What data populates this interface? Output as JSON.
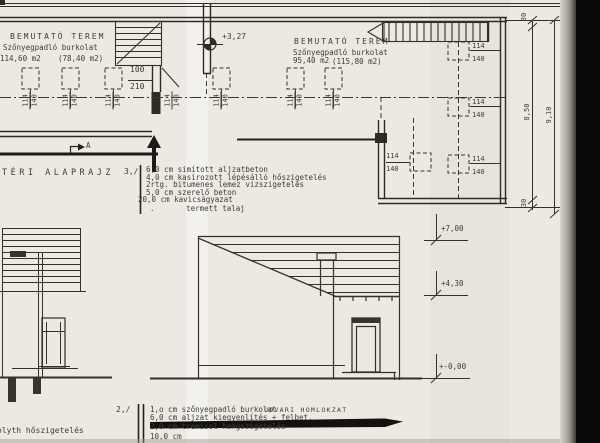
{
  "drawing": {
    "plan": {
      "title": "TÉRI ALAPRAJZ",
      "rooms": [
        {
          "name": "BEMUTATÓ TEREM",
          "finish": "Szőnyegpadló burkolat",
          "area": "114,60 m2",
          "area_alt": "(78,40 m2)"
        },
        {
          "name": "BEMUTATÓ TEREM",
          "finish": "Szőnyegpadló burkolat",
          "area": "95,40 m2",
          "area_alt": "(115,80 m2)"
        }
      ],
      "level_mark": "+3,27",
      "door_width": "100",
      "door_height": "210",
      "opening_width": "114",
      "opening_height": "140",
      "section_letter": "A"
    },
    "dims": {
      "top_wall": "30",
      "bottom_wall": "30",
      "inner": "8,50",
      "outer": "9,10"
    },
    "floor_notes": {
      "index": "3,/",
      "lines": [
        "6,0 cm simított aljzatbeton",
        "4,0 cm kasírozott lépésálló hőszigetelés",
        "2rtg. bitumenes lemez vizszigetelés",
        "5,0 cm szerelő beton",
        "20,0 cm kavicságyazat",
        ".       termett talaj"
      ]
    },
    "slab_notes": {
      "index": "2,/",
      "lines": [
        "1,o cm szőnyegpadló burkolat",
        "6,0 cm aljzat kiegyenlítés + felbet.",
        "2,0 cm tremisol hangszigetelés",
        "10,0 cm"
      ]
    },
    "elevation": {
      "title": "UDVARI HOMLOKZAT",
      "level_ridge": "+7,00",
      "level_eaves": "+4,30",
      "level_ground": "+-0,00"
    },
    "edge_text": "olyth hőszigetelés"
  }
}
